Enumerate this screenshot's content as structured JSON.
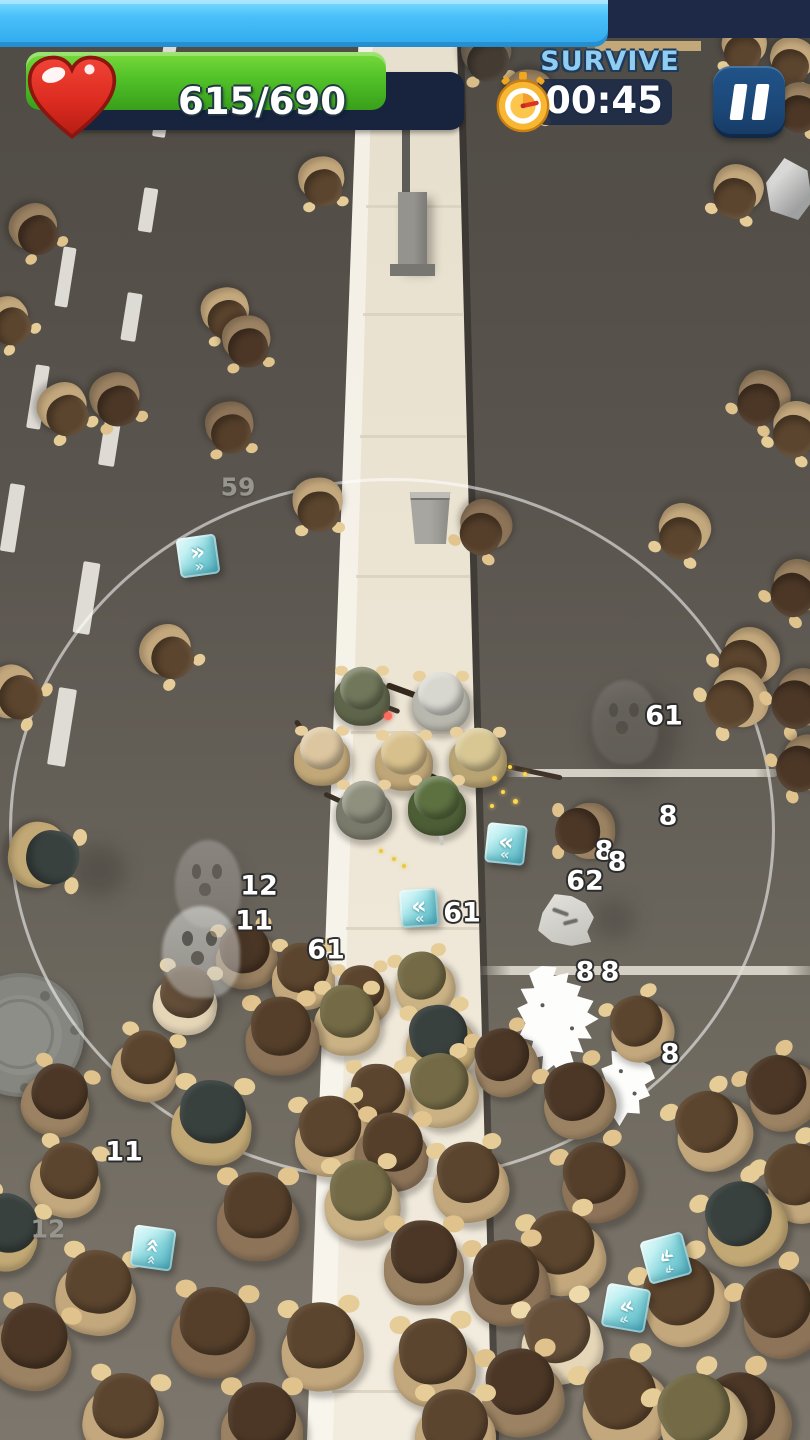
{
  "hud": {
    "progress_bar": {
      "fill_percent": 75,
      "fill_color": "#49c0f8",
      "track_color": "#1e2947"
    },
    "health": {
      "current": 615,
      "max": 690,
      "display": "615/690",
      "percent": 89,
      "bar_color": "#52c229",
      "track_color": "#18233e",
      "icon": "heart-icon",
      "heart_color": "#e23128"
    },
    "objective": {
      "label": "SURVIVE",
      "timer": "00:45",
      "icon": "stopwatch-icon",
      "label_color": "#90cef1",
      "pill_color": "#1e2a47"
    },
    "pause": {
      "icon": "pause-icon",
      "color": "#1b4777"
    }
  },
  "scene": {
    "range_circle": {
      "cx": 392,
      "cy": 830,
      "rx": 383,
      "ry": 352,
      "color": "rgba(255,255,255,0.55)"
    },
    "palettes": {
      "v1": {
        "hair": "#5c452e",
        "body": "#c4a87d",
        "hand": "#e6cc96"
      },
      "v2": {
        "hair": "#4c3726",
        "body": "#9b8262",
        "hand": "#dfc28c"
      },
      "v3": {
        "hair": "#66503a",
        "body": "#e6d6b8",
        "hand": "#eed9ab"
      },
      "v4": {
        "hair": "#553f2a",
        "body": "#8d7459",
        "hand": "#e2c48e"
      },
      "v5": {
        "hair": "#746b46",
        "body": "#cbb285",
        "hand": "#e6cc96"
      },
      "v6": {
        "hair": "#39413f",
        "body": "#c2a874",
        "hand": "#e6cc96"
      },
      "v7": {
        "hair": "#443c33",
        "body": "#6f6456",
        "hand": "#d9bd88"
      }
    },
    "zombies": [
      {
        "x": 487,
        "y": 55,
        "s": 56,
        "r": 170,
        "v": "v7"
      },
      {
        "x": 529,
        "y": 96,
        "s": 54,
        "r": 185,
        "v": "v2"
      },
      {
        "x": 744,
        "y": 48,
        "s": 50,
        "r": 190,
        "v": "v1"
      },
      {
        "x": 792,
        "y": 62,
        "s": 50,
        "r": 195,
        "v": "v1"
      },
      {
        "x": 800,
        "y": 108,
        "s": 52,
        "r": 195,
        "v": "v2"
      },
      {
        "x": 737,
        "y": 192,
        "s": 56,
        "r": 200,
        "v": "v1"
      },
      {
        "x": 322,
        "y": 182,
        "s": 52,
        "r": 170,
        "v": "v1"
      },
      {
        "x": 35,
        "y": 230,
        "s": 54,
        "r": 150,
        "v": "v2"
      },
      {
        "x": 8,
        "y": 322,
        "s": 52,
        "r": 140,
        "v": "v1"
      },
      {
        "x": 64,
        "y": 410,
        "s": 56,
        "r": 150,
        "v": "v1"
      },
      {
        "x": 116,
        "y": 400,
        "s": 56,
        "r": 160,
        "v": "v2"
      },
      {
        "x": 226,
        "y": 314,
        "s": 54,
        "r": 165,
        "v": "v1"
      },
      {
        "x": 247,
        "y": 342,
        "s": 54,
        "r": 170,
        "v": "v2"
      },
      {
        "x": 230,
        "y": 428,
        "s": 54,
        "r": 170,
        "v": "v4"
      },
      {
        "x": 318,
        "y": 505,
        "s": 56,
        "r": 175,
        "v": "v1"
      },
      {
        "x": 484,
        "y": 528,
        "s": 58,
        "r": 210,
        "v": "v4"
      },
      {
        "x": 762,
        "y": 399,
        "s": 58,
        "r": 215,
        "v": "v2"
      },
      {
        "x": 797,
        "y": 430,
        "s": 58,
        "r": 210,
        "v": "v1"
      },
      {
        "x": 683,
        "y": 532,
        "s": 58,
        "r": 205,
        "v": "v1"
      },
      {
        "x": 797,
        "y": 589,
        "s": 60,
        "r": 220,
        "v": "v2"
      },
      {
        "x": 748,
        "y": 659,
        "s": 64,
        "r": 230,
        "v": "v1"
      },
      {
        "x": 736,
        "y": 700,
        "s": 66,
        "r": 240,
        "v": "v1"
      },
      {
        "x": 801,
        "y": 700,
        "s": 64,
        "r": 235,
        "v": "v2"
      },
      {
        "x": 168,
        "y": 653,
        "s": 58,
        "r": 140,
        "v": "v1"
      },
      {
        "x": 14,
        "y": 694,
        "s": 60,
        "r": 120,
        "v": "v1"
      },
      {
        "x": 585,
        "y": 831,
        "s": 62,
        "r": 270,
        "v": "v2"
      },
      {
        "x": 805,
        "y": 765,
        "s": 62,
        "r": 240,
        "v": "v2"
      },
      {
        "x": 44,
        "y": 856,
        "s": 74,
        "r": 100,
        "v": "v6"
      },
      {
        "x": 246,
        "y": 956,
        "s": 68,
        "r": 350,
        "v": "v2"
      },
      {
        "x": 303,
        "y": 976,
        "s": 70,
        "r": 0,
        "v": "v1"
      },
      {
        "x": 186,
        "y": 1000,
        "s": 72,
        "r": 10,
        "v": "v3"
      },
      {
        "x": 282,
        "y": 1036,
        "s": 82,
        "r": 355,
        "v": "v4"
      },
      {
        "x": 347,
        "y": 1020,
        "s": 74,
        "r": 0,
        "v": "v5"
      },
      {
        "x": 146,
        "y": 1066,
        "s": 74,
        "r": 15,
        "v": "v1"
      },
      {
        "x": 57,
        "y": 1100,
        "s": 76,
        "r": 20,
        "v": "v2"
      },
      {
        "x": 212,
        "y": 1122,
        "s": 88,
        "r": 5,
        "v": "v6"
      },
      {
        "x": 332,
        "y": 1136,
        "s": 84,
        "r": 350,
        "v": "v1"
      },
      {
        "x": 67,
        "y": 1180,
        "s": 78,
        "r": 15,
        "v": "v1"
      },
      {
        "x": 4,
        "y": 1232,
        "s": 80,
        "r": 25,
        "v": "v6"
      },
      {
        "x": 258,
        "y": 1216,
        "s": 92,
        "r": 0,
        "v": "v4"
      },
      {
        "x": 362,
        "y": 1200,
        "s": 84,
        "r": 355,
        "v": "v5"
      },
      {
        "x": 97,
        "y": 1292,
        "s": 88,
        "r": 10,
        "v": "v1"
      },
      {
        "x": 32,
        "y": 1346,
        "s": 90,
        "r": 15,
        "v": "v2"
      },
      {
        "x": 214,
        "y": 1332,
        "s": 94,
        "r": 5,
        "v": "v4"
      },
      {
        "x": 322,
        "y": 1346,
        "s": 92,
        "r": 355,
        "v": "v1"
      },
      {
        "x": 124,
        "y": 1416,
        "s": 90,
        "r": 10,
        "v": "v1"
      },
      {
        "x": 262,
        "y": 1426,
        "s": 92,
        "r": 0,
        "v": "v2"
      },
      {
        "x": 424,
        "y": 983,
        "s": 66,
        "r": 345,
        "v": "v5"
      },
      {
        "x": 362,
        "y": 995,
        "s": 62,
        "r": 355,
        "v": "v1"
      },
      {
        "x": 440,
        "y": 1042,
        "s": 78,
        "r": 350,
        "v": "v6"
      },
      {
        "x": 442,
        "y": 1090,
        "s": 78,
        "r": 345,
        "v": "v5"
      },
      {
        "x": 378,
        "y": 1098,
        "s": 72,
        "r": 0,
        "v": "v1"
      },
      {
        "x": 505,
        "y": 1062,
        "s": 72,
        "r": 340,
        "v": "v2"
      },
      {
        "x": 392,
        "y": 1152,
        "s": 82,
        "r": 5,
        "v": "v4"
      },
      {
        "x": 470,
        "y": 1182,
        "s": 84,
        "r": 350,
        "v": "v1"
      },
      {
        "x": 424,
        "y": 1262,
        "s": 88,
        "r": 0,
        "v": "v2"
      },
      {
        "x": 508,
        "y": 1282,
        "s": 90,
        "r": 350,
        "v": "v4"
      },
      {
        "x": 434,
        "y": 1362,
        "s": 92,
        "r": 355,
        "v": "v1"
      },
      {
        "x": 522,
        "y": 1392,
        "s": 92,
        "r": 350,
        "v": "v2"
      },
      {
        "x": 455,
        "y": 1432,
        "s": 90,
        "r": 0,
        "v": "v1"
      },
      {
        "x": 578,
        "y": 1100,
        "s": 80,
        "r": 340,
        "v": "v2"
      },
      {
        "x": 640,
        "y": 1028,
        "s": 70,
        "r": 335,
        "v": "v1"
      },
      {
        "x": 712,
        "y": 1130,
        "s": 84,
        "r": 330,
        "v": "v1"
      },
      {
        "x": 782,
        "y": 1092,
        "s": 80,
        "r": 325,
        "v": "v2"
      },
      {
        "x": 744,
        "y": 1222,
        "s": 88,
        "r": 330,
        "v": "v6"
      },
      {
        "x": 802,
        "y": 1182,
        "s": 84,
        "r": 325,
        "v": "v1"
      },
      {
        "x": 684,
        "y": 1300,
        "s": 94,
        "r": 335,
        "v": "v1"
      },
      {
        "x": 782,
        "y": 1312,
        "s": 94,
        "r": 330,
        "v": "v4"
      },
      {
        "x": 624,
        "y": 1404,
        "s": 98,
        "r": 340,
        "v": "v1"
      },
      {
        "x": 744,
        "y": 1418,
        "s": 98,
        "r": 335,
        "v": "v2"
      },
      {
        "x": 564,
        "y": 1252,
        "s": 88,
        "r": 345,
        "v": "v1"
      },
      {
        "x": 598,
        "y": 1182,
        "s": 84,
        "r": 340,
        "v": "v4"
      },
      {
        "x": 700,
        "y": 1418,
        "s": 96,
        "r": 330,
        "v": "v5"
      },
      {
        "x": 560,
        "y": 1340,
        "s": 90,
        "r": 345,
        "v": "v3"
      }
    ],
    "soldiers": [
      {
        "x": 362,
        "y": 696,
        "s": 64,
        "helm": "#70775a",
        "body": "#5e654a",
        "gun": {
          "a": 20,
          "l": 40,
          "c": "#3a3126",
          "w": 5
        }
      },
      {
        "x": 441,
        "y": 702,
        "s": 66,
        "helm": "#d8d7cf",
        "body": "#b9b8ae",
        "gun": {
          "a": 200,
          "l": 58,
          "c": "#35291d",
          "w": 6
        }
      },
      {
        "x": 322,
        "y": 756,
        "s": 64,
        "helm": "#dcc6a0",
        "body": "#c2a878",
        "gun": {
          "a": 235,
          "l": 46,
          "c": "#3a2f22",
          "w": 5
        }
      },
      {
        "x": 404,
        "y": 761,
        "s": 66,
        "helm": "#d8c08c",
        "body": "#bfa678",
        "gun": {
          "a": 25,
          "l": 46,
          "c": "#2e261c",
          "w": 7
        }
      },
      {
        "x": 478,
        "y": 758,
        "s": 66,
        "helm": "#d8c793",
        "body": "#b8a372",
        "gun": {
          "a": 12,
          "l": 86,
          "c": "#40342a",
          "w": 5
        }
      },
      {
        "x": 364,
        "y": 810,
        "s": 64,
        "helm": "#90907f",
        "body": "#7a7a6c",
        "gun": {
          "a": 205,
          "l": 44,
          "c": "#3a3126",
          "w": 5
        }
      },
      {
        "x": 437,
        "y": 806,
        "s": 66,
        "helm": "#5c7040",
        "body": "#4d5e36",
        "gun": {
          "a": 82,
          "l": 38,
          "c": "#c9c9c4",
          "w": 4
        }
      }
    ],
    "loot_cubes": [
      {
        "x": 198,
        "y": 556,
        "s": 40,
        "rot": -8,
        "chev": 180
      },
      {
        "x": 506,
        "y": 844,
        "s": 40,
        "rot": 6,
        "chev": 0
      },
      {
        "x": 419,
        "y": 908,
        "s": 38,
        "rot": -4,
        "chev": 0
      },
      {
        "x": 153,
        "y": 1248,
        "s": 42,
        "rot": 8,
        "chev": 90
      },
      {
        "x": 666,
        "y": 1258,
        "s": 44,
        "rot": -15,
        "chev": -30
      },
      {
        "x": 626,
        "y": 1308,
        "s": 44,
        "rot": 10,
        "chev": -25
      }
    ],
    "damage_numbers": [
      {
        "value": "59",
        "x": 238,
        "y": 487,
        "variant": "gray"
      },
      {
        "value": "61",
        "x": 664,
        "y": 716,
        "variant": "white"
      },
      {
        "value": "8",
        "x": 668,
        "y": 816,
        "variant": "white"
      },
      {
        "value": "8",
        "x": 604,
        "y": 851,
        "variant": "white"
      },
      {
        "value": "8",
        "x": 617,
        "y": 862,
        "variant": "white"
      },
      {
        "value": "62",
        "x": 585,
        "y": 881,
        "variant": "white"
      },
      {
        "value": "12",
        "x": 259,
        "y": 886,
        "variant": "white"
      },
      {
        "value": "11",
        "x": 254,
        "y": 921,
        "variant": "white"
      },
      {
        "value": "61",
        "x": 462,
        "y": 913,
        "variant": "white"
      },
      {
        "value": "61",
        "x": 326,
        "y": 950,
        "variant": "white"
      },
      {
        "value": "8",
        "x": 585,
        "y": 972,
        "variant": "white"
      },
      {
        "value": "8",
        "x": 610,
        "y": 972,
        "variant": "white"
      },
      {
        "value": "8",
        "x": 670,
        "y": 1054,
        "variant": "white"
      },
      {
        "value": "11",
        "x": 124,
        "y": 1152,
        "variant": "white"
      },
      {
        "value": "12",
        "x": 48,
        "y": 1229,
        "variant": "gray"
      }
    ],
    "ghosts": [
      {
        "x": 208,
        "y": 884,
        "w": 66,
        "h": 88,
        "o": 0.25
      },
      {
        "x": 201,
        "y": 952,
        "w": 78,
        "h": 92,
        "o": 0.5
      },
      {
        "x": 625,
        "y": 722,
        "w": 66,
        "h": 84,
        "o": 0.12
      }
    ],
    "splats": [
      {
        "x": 560,
        "y": 1022,
        "w": 86,
        "h": 116,
        "rot": -8,
        "shape": "p1"
      },
      {
        "x": 628,
        "y": 1086,
        "w": 62,
        "h": 82,
        "rot": 12,
        "shape": "p2"
      }
    ],
    "ash_pile": {
      "x": 566,
      "y": 920,
      "w": 56,
      "h": 52
    },
    "beams": [
      {
        "x": 505,
        "y": 769,
        "w": 272,
        "h": 8
      },
      {
        "x": 478,
        "y": 966,
        "w": 334,
        "h": 9
      }
    ],
    "sparks": [
      {
        "x": 492,
        "y": 776,
        "s": 5,
        "c": "#ffd84d"
      },
      {
        "x": 501,
        "y": 790,
        "s": 4,
        "c": "#ffd84d"
      },
      {
        "x": 513,
        "y": 799,
        "s": 5,
        "c": "#ffd84d"
      },
      {
        "x": 523,
        "y": 772,
        "s": 4,
        "c": "#ffd84d"
      },
      {
        "x": 490,
        "y": 804,
        "s": 4,
        "c": "#ffd84d"
      },
      {
        "x": 508,
        "y": 765,
        "s": 4,
        "c": "#ffd84d"
      },
      {
        "x": 379,
        "y": 849,
        "s": 4,
        "c": "#e8c93e"
      },
      {
        "x": 392,
        "y": 857,
        "s": 4,
        "c": "#e8c93e"
      },
      {
        "x": 402,
        "y": 864,
        "s": 4,
        "c": "#e8c93e"
      },
      {
        "x": 384,
        "y": 712,
        "s": 8,
        "c": "#ff6a5e"
      }
    ],
    "lane_dashes": [
      {
        "x": 170,
        "y": 43,
        "w": 13,
        "h": 22
      },
      {
        "x": 159,
        "y": 130,
        "w": 13,
        "h": 14
      },
      {
        "x": 148,
        "y": 210,
        "w": 14,
        "h": 44
      },
      {
        "x": 131,
        "y": 317,
        "w": 15,
        "h": 48
      },
      {
        "x": 110,
        "y": 440,
        "w": 16,
        "h": 52
      },
      {
        "x": 86,
        "y": 598,
        "w": 17,
        "h": 72
      },
      {
        "x": 62,
        "y": 727,
        "w": 18,
        "h": 78
      },
      {
        "x": 65,
        "y": 277,
        "w": 13,
        "h": 60
      },
      {
        "x": 38,
        "y": 397,
        "w": 14,
        "h": 64
      },
      {
        "x": 12,
        "y": 518,
        "w": 15,
        "h": 68
      }
    ],
    "walk_seams": [
      205,
      313,
      435,
      575,
      731,
      927,
      1150,
      1390
    ]
  }
}
